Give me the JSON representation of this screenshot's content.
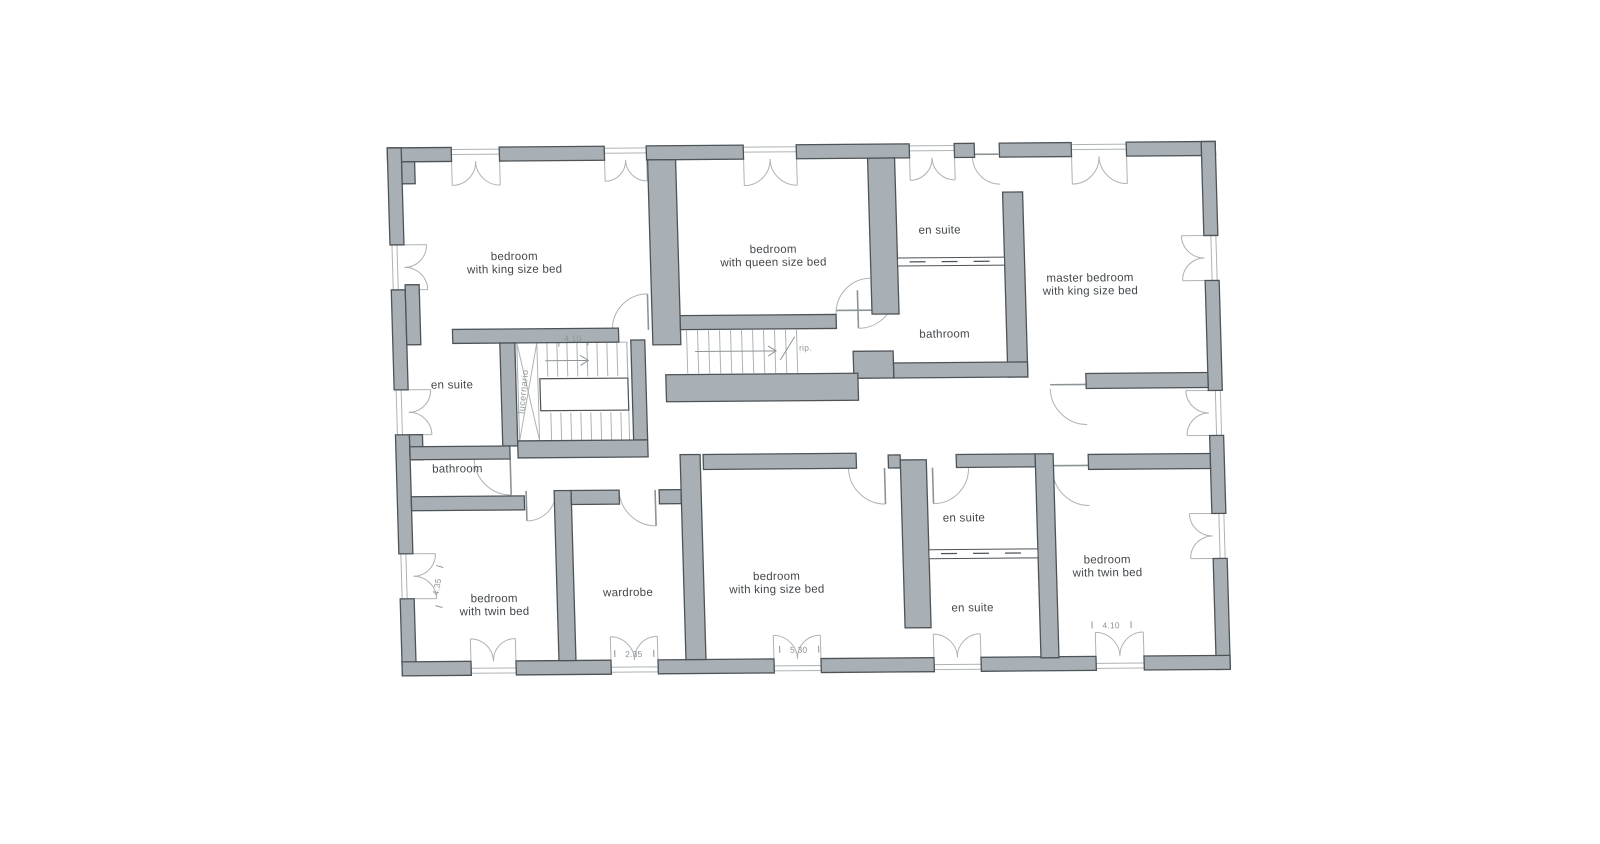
{
  "plan": {
    "rooms": [
      {
        "id": "bedroom-king-top",
        "line1": "bedroom",
        "line2": "with king size bed"
      },
      {
        "id": "bedroom-queen",
        "line1": "bedroom",
        "line2": "with queen size bed"
      },
      {
        "id": "ensuite-top",
        "line1": "en suite"
      },
      {
        "id": "master-bedroom",
        "line1": "master bedroom",
        "line2": "with king size bed"
      },
      {
        "id": "bathroom-top",
        "line1": "bathroom"
      },
      {
        "id": "ensuite-left",
        "line1": "en suite"
      },
      {
        "id": "bathroom-left",
        "line1": "bathroom"
      },
      {
        "id": "bedroom-twin-left",
        "line1": "bedroom",
        "line2": "with twin bed"
      },
      {
        "id": "wardrobe",
        "line1": "wardrobe"
      },
      {
        "id": "bedroom-king-bottom",
        "line1": "bedroom",
        "line2": "with king size bed"
      },
      {
        "id": "ensuite-right-upper",
        "line1": "en suite"
      },
      {
        "id": "ensuite-right-lower",
        "line1": "en suite"
      },
      {
        "id": "bedroom-twin-right",
        "line1": "bedroom",
        "line2": "with twin bed"
      }
    ],
    "annotations": {
      "stair_skylight": "lucernario",
      "stair_dim": "4.10",
      "stair2_label": "rip.",
      "dim_left_wall": "4.35",
      "dim_wardrobe": "2.35",
      "dim_king_bottom": "5.30",
      "dim_twin_right": "4.10"
    },
    "colors": {
      "wall_fill": "#a8b0b5",
      "wall_stroke": "#4e5357",
      "line": "#adb3b6",
      "line_dark": "#8d9498",
      "text": "#43484c",
      "background": "#ffffff"
    }
  }
}
